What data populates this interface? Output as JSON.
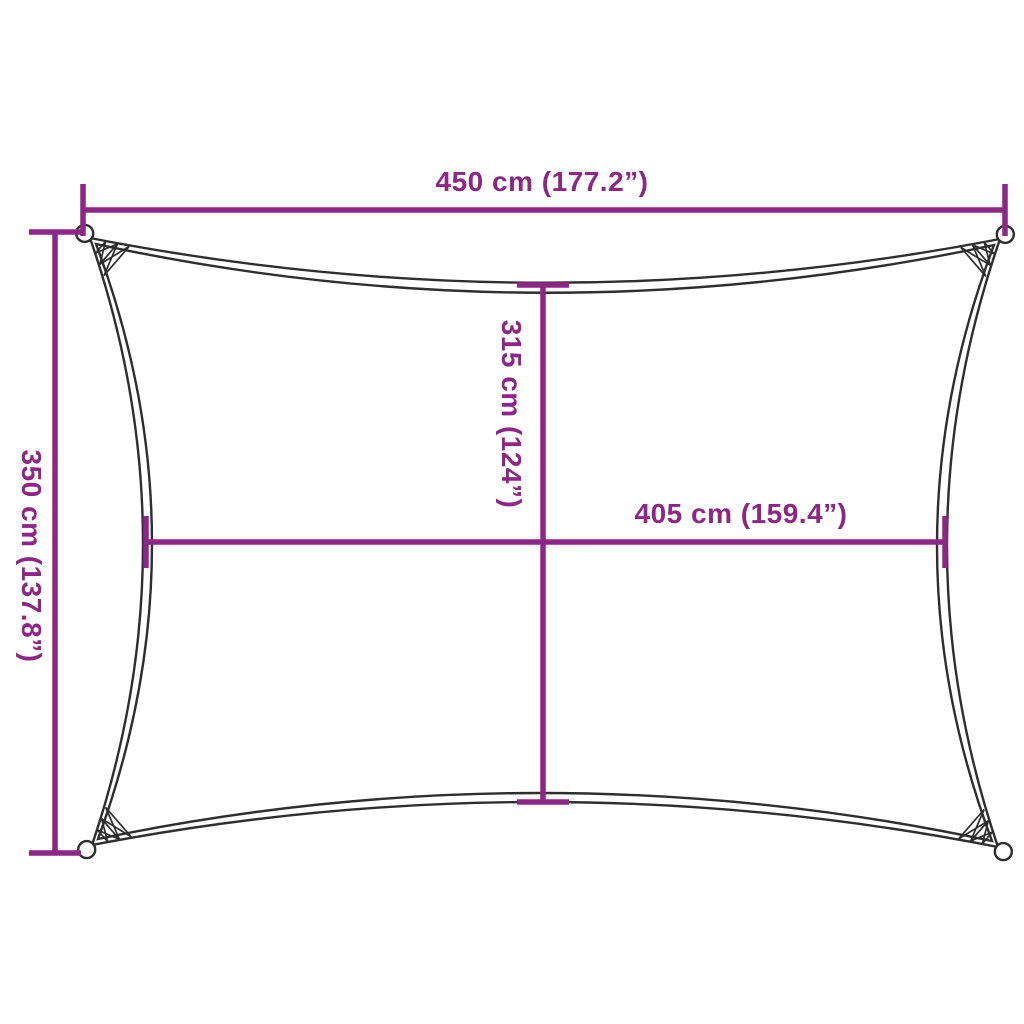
{
  "diagram": {
    "subject": "rectangular-shade-sail-dimension-diagram",
    "background_color": "#ffffff",
    "outline_color": "#2e2e2e",
    "dimension_color": "#8e2687",
    "labels": {
      "top_width": "450 cm (177.2”)",
      "left_height": "350 cm (137.8”)",
      "inner_height": "315 cm (124”)",
      "inner_width": "405 cm (159.4”)"
    }
  }
}
